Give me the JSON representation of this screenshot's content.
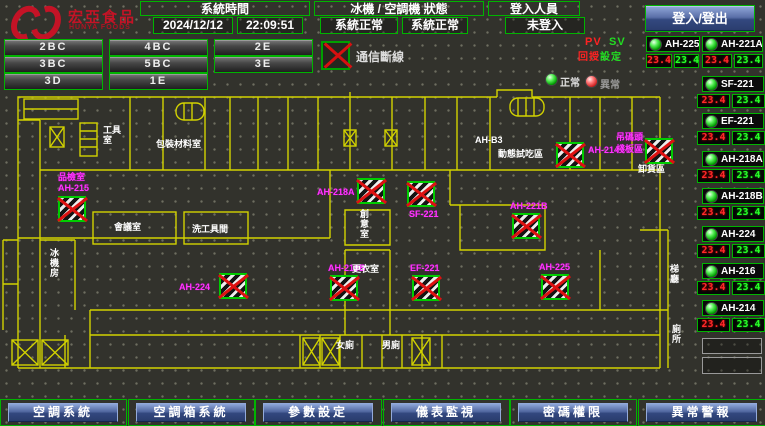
{
  "header": {
    "logo": {
      "name": "宏亞食品",
      "sub": "HUNYA FOODS"
    },
    "clock": {
      "title": "系統時間",
      "date": "2024/12/12",
      "time": "22:09:51"
    },
    "status": {
      "title": "冰機 / 空調機 狀態",
      "left": "系統正常",
      "right": "系統正常"
    },
    "login": {
      "title": "登入人員",
      "state": "未登入",
      "button": "登入/登出"
    }
  },
  "floor_nav": [
    "2BC",
    "4BC",
    "2E",
    "3BC",
    "5BC",
    "3E",
    "3D",
    "1E"
  ],
  "indicators": {
    "comm": "通信斷線",
    "pv": "PV",
    "sv": "SV",
    "pv_cn": "回授",
    "sv_cn": "設定",
    "normal": "正常",
    "abnormal": "異常"
  },
  "ahu_panel": [
    {
      "name": "AH-225",
      "pv": "23.4",
      "sv": "23.4"
    },
    {
      "name": "AH-221A",
      "pv": "23.4",
      "sv": "23.4"
    },
    {
      "name": "SF-221",
      "pv": "23.4",
      "sv": "23.4"
    },
    {
      "name": "EF-221",
      "pv": "23.4",
      "sv": "23.4"
    },
    {
      "name": "AH-218A",
      "pv": "23.4",
      "sv": "23.4"
    },
    {
      "name": "AH-218B",
      "pv": "23.4",
      "sv": "23.4"
    },
    {
      "name": "AH-224",
      "pv": "23.4",
      "sv": "23.4"
    },
    {
      "name": "AH-216",
      "pv": "23.4",
      "sv": "23.4"
    },
    {
      "name": "AH-214",
      "pv": "23.4",
      "sv": "23.4"
    }
  ],
  "map": {
    "units": [
      {
        "label": "品檢室",
        "label2": "AH-215",
        "x": 58,
        "y": 196,
        "lp": "above2"
      },
      {
        "label": "AH-224",
        "x": 219,
        "y": 273,
        "lp": "left"
      },
      {
        "label": "AH-218A",
        "x": 357,
        "y": 178,
        "lp": "left"
      },
      {
        "label": "SF-221",
        "x": 407,
        "y": 181,
        "lp": "below"
      },
      {
        "label": "AH-218B",
        "x": 330,
        "y": 275,
        "lp": "above"
      },
      {
        "label": "EF-221",
        "x": 412,
        "y": 275,
        "lp": "above"
      },
      {
        "label": "AH-221B",
        "x": 512,
        "y": 213,
        "lp": "above"
      },
      {
        "label": "AH-214",
        "x": 556,
        "y": 142,
        "lp": "right"
      },
      {
        "label": "",
        "x": 645,
        "y": 138,
        "lp": "none"
      },
      {
        "label": "AH-225",
        "x": 541,
        "y": 274,
        "lp": "above"
      }
    ],
    "labels": [
      {
        "text": "工具室",
        "x": 103,
        "y": 125,
        "kind": "room",
        "w": 26
      },
      {
        "text": "包裝材料室",
        "x": 156,
        "y": 139,
        "kind": "room"
      },
      {
        "text": "AH-B3",
        "x": 475,
        "y": 135,
        "kind": "room"
      },
      {
        "text": "動態試吃區",
        "x": 498,
        "y": 149,
        "kind": "room"
      },
      {
        "text": "卸貨區",
        "x": 638,
        "y": 164,
        "kind": "room"
      },
      {
        "text": "會議室",
        "x": 114,
        "y": 222,
        "kind": "room"
      },
      {
        "text": "洗工具間",
        "x": 192,
        "y": 224,
        "kind": "room"
      },
      {
        "text": "冰機房",
        "x": 50,
        "y": 248,
        "kind": "room",
        "w": 14
      },
      {
        "text": "創意室",
        "x": 360,
        "y": 209,
        "kind": "room",
        "w": 14
      },
      {
        "text": "更衣室",
        "x": 352,
        "y": 264,
        "kind": "room"
      },
      {
        "text": "女廁",
        "x": 336,
        "y": 340,
        "kind": "room"
      },
      {
        "text": "男廁",
        "x": 382,
        "y": 340,
        "kind": "room"
      },
      {
        "text": "梯廳",
        "x": 670,
        "y": 264,
        "kind": "room",
        "w": 14
      },
      {
        "text": "廁所",
        "x": 672,
        "y": 324,
        "kind": "room",
        "w": 14
      },
      {
        "text": "吊碼頭",
        "x": 616,
        "y": 132,
        "kind": "tag"
      },
      {
        "text": "棧板區",
        "x": 616,
        "y": 144,
        "kind": "tag"
      }
    ]
  },
  "footer": [
    "空調系統",
    "空調箱系統",
    "參數設定",
    "儀表監視",
    "密碼權限",
    "異常警報"
  ]
}
